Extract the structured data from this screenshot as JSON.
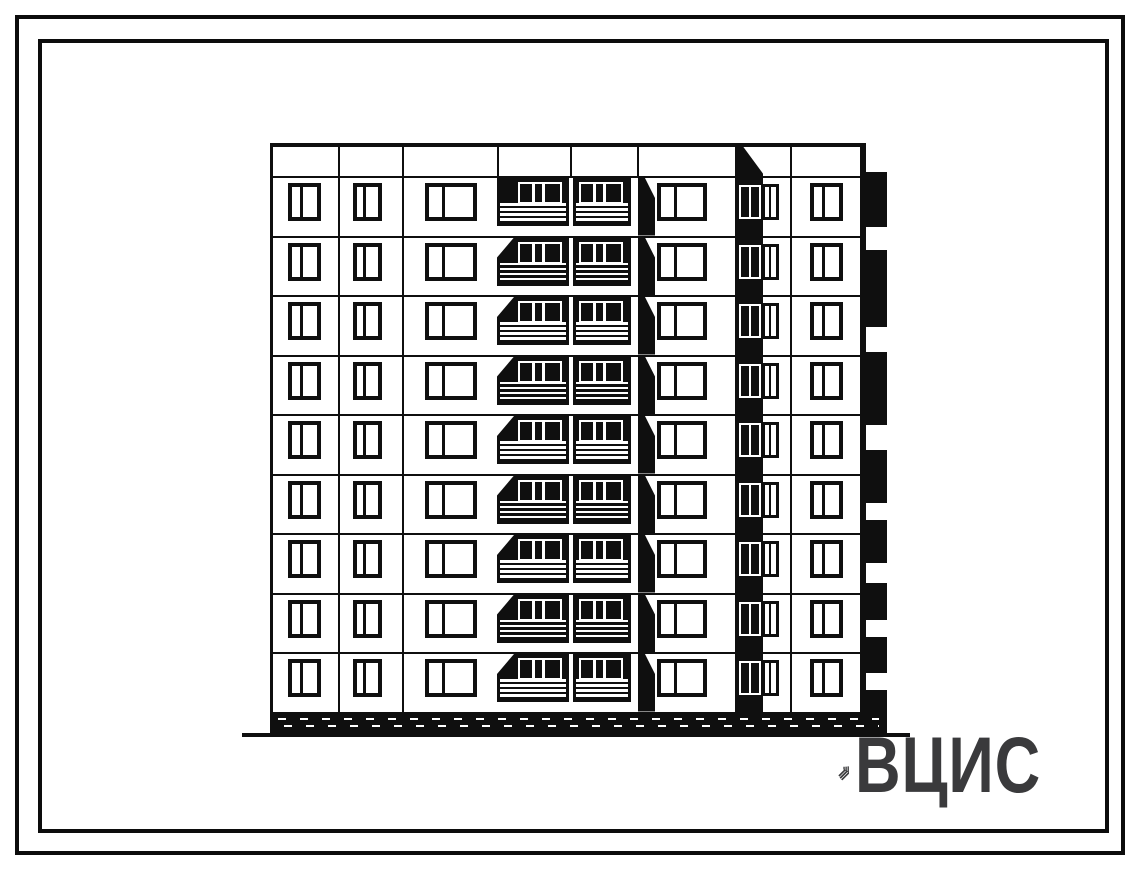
{
  "logo": {
    "text": "ВЦИС",
    "color": "#3a3a3c",
    "mark": "diagonal-stripes-mark"
  },
  "drawing": {
    "kind": "nine-story large-panel building facade elevation, black ink on white paper",
    "floors": 9,
    "ink": "#0f0f0f",
    "paper": "#ffffff",
    "bays": [
      {
        "id": "bay-1",
        "type": "window"
      },
      {
        "id": "bay-2",
        "type": "window"
      },
      {
        "id": "bay-3",
        "type": "window"
      },
      {
        "id": "bay-4",
        "type": "balcony"
      },
      {
        "id": "bay-5",
        "type": "balcony"
      },
      {
        "id": "bay-6",
        "type": "window"
      },
      {
        "id": "bay-7",
        "type": "stairwell"
      },
      {
        "id": "bay-8",
        "type": "window"
      }
    ],
    "features": [
      "ground-line",
      "hatched-plinth",
      "side-balconies-right-edge",
      "parapet-band"
    ]
  }
}
